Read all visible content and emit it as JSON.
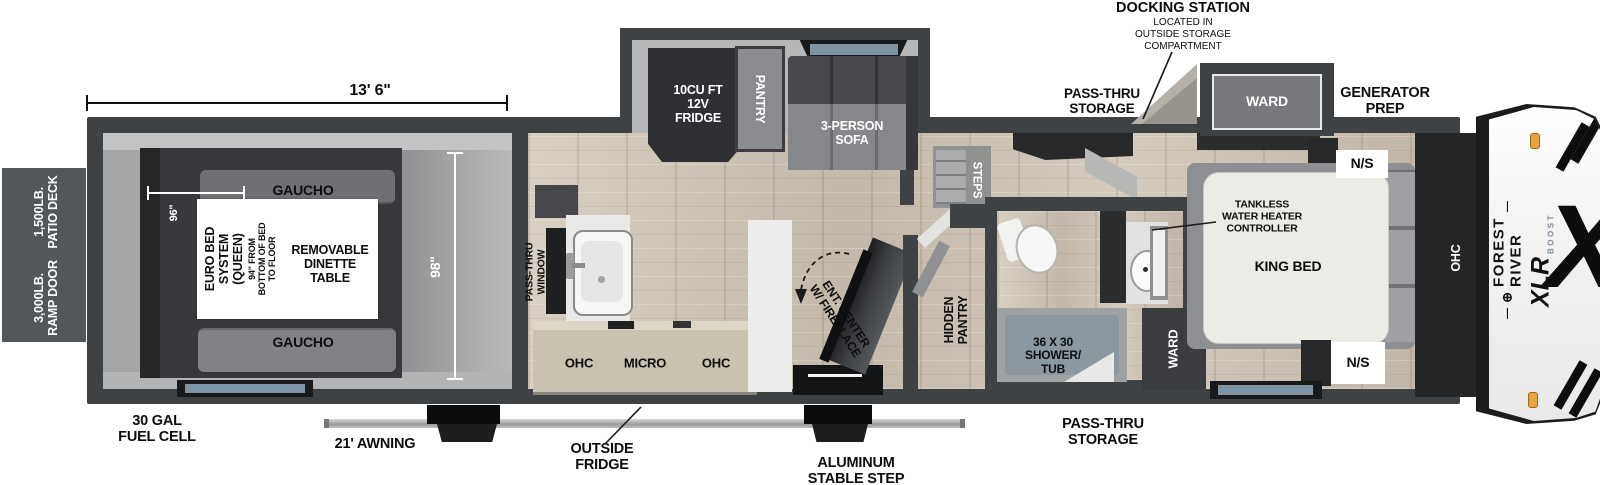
{
  "exterior": {
    "patio_deck": [
      "1,500LB.",
      "PATIO DECK"
    ],
    "ramp_door": [
      "3,000LB.",
      "RAMP DOOR"
    ],
    "fuel_cell": [
      "30 GAL",
      "FUEL CELL"
    ],
    "awning": "21' AWNING",
    "outside_fridge": [
      "OUTSIDE",
      "FRIDGE"
    ],
    "stable_step": [
      "ALUMINUM",
      "STABLE STEP"
    ],
    "pass_thru_storage_bottom": [
      "PASS-THRU",
      "STORAGE"
    ],
    "pass_thru_storage_top": [
      "PASS-THRU",
      "STORAGE"
    ],
    "generator_prep": [
      "GENERATOR",
      "PREP"
    ],
    "docking_station": {
      "title": "DOCKING STATION",
      "note": [
        "LOCATED IN",
        "OUTSIDE STORAGE",
        "COMPARTMENT"
      ]
    }
  },
  "dimensions": {
    "garage_width": "13' 6\"",
    "bed_area_width": "96\"",
    "body_width": "98\""
  },
  "garage": {
    "gaucho_top": "GAUCHO",
    "gaucho_bottom": "GAUCHO",
    "euro_bed": [
      "EURO BED",
      "SYSTEM",
      "(QUEEN)"
    ],
    "bed_height_note": [
      "94\" FROM",
      "BOTTOM OF BED",
      "TO FLOOR"
    ],
    "dinette": [
      "REMOVABLE",
      "DINETTE",
      "TABLE"
    ]
  },
  "kitchen": {
    "pass_thru_window": [
      "PASS-THRU",
      "WINDOW"
    ],
    "ohc_left": "OHC",
    "micro": "MICRO",
    "ohc_right": "OHC"
  },
  "living": {
    "fridge": [
      "10CU FT",
      "12V",
      "FRIDGE"
    ],
    "pantry": "PANTRY",
    "sofa": [
      "3-PERSON",
      "SOFA"
    ],
    "ent_center": [
      "ENT. CENTER",
      "W/ FIREPLACE"
    ],
    "hidden_pantry": [
      "HIDDEN",
      "PANTRY"
    ],
    "steps": "STEPS"
  },
  "bathroom": {
    "shower": [
      "36 X 30",
      "SHOWER/",
      "TUB"
    ],
    "ward": "WARD"
  },
  "bedroom": {
    "ward_slide": "WARD",
    "tankless": [
      "TANKLESS",
      "WATER HEATER",
      "CONTROLLER"
    ],
    "king_bed": "KING BED",
    "nightstand_top": "N/S",
    "nightstand_bottom": "N/S",
    "ohc": "OHC"
  },
  "brand": {
    "logo_mark": "⊕",
    "name": "FOREST RIVER",
    "model": "XLR",
    "submodel": "BOOST",
    "x_graphic": "X"
  },
  "colors": {
    "wall": "#3f4245",
    "wood": "#cdc3b5",
    "marker_light": "#e8a33d",
    "slide_floor": "#b5b7b9"
  }
}
